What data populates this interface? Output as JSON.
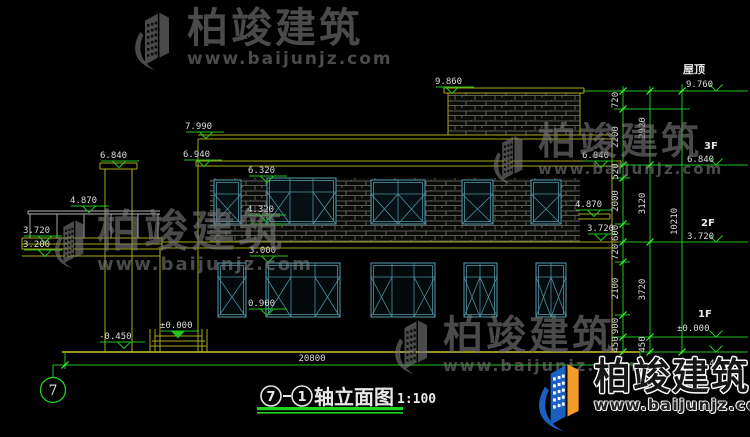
{
  "brand": {
    "name": "柏竣建筑",
    "url": "www.baijunjz.com"
  },
  "title": {
    "axis_from": "7",
    "joiner": "—",
    "axis_to": "1",
    "text": "轴立面图",
    "scale": "1:100"
  },
  "axis_bubble": "7",
  "spot": {
    "stair_roof": "9.860",
    "parapet": "7.990",
    "eave": "6.940",
    "chimney": "6.840",
    "right_eave": "6.840",
    "win2_top": "6.320",
    "balcony": "4.870",
    "right_canopy": "4.870",
    "win2_sill": "4.320",
    "balcony_slab": "3.720",
    "right_slab": "3.720",
    "balcony_beam": "3.200",
    "win1_top": "3.000",
    "win1_sill": "0.900",
    "entrance": "±0.000",
    "ground": "-0.450"
  },
  "levels": [
    {
      "name": "屋顶",
      "value": "9.760"
    },
    {
      "name": "3F",
      "value": "6.840"
    },
    {
      "name": "2F",
      "value": "3.720"
    },
    {
      "name": "1F",
      "value": "±0.000"
    },
    {
      "name": "",
      "value": "-0.450"
    }
  ],
  "dims": {
    "total_width": "20800",
    "chain_inner": [
      "720",
      "2200",
      "520",
      "2000",
      "600",
      "720",
      "2100",
      "900",
      "450"
    ],
    "chain_mid": [
      "2920",
      "3120",
      "3720",
      "450"
    ],
    "overall": "10210"
  },
  "colors": {
    "background": "#000000",
    "dim_green": "#21c521",
    "line_yellow": "#a8a816",
    "window_teal": "#4e8e9e",
    "text_white": "#dcdcdc",
    "watermark_gray": "#787878",
    "brand_blue": "#1a60c0",
    "brand_orange": "#f19c2b"
  }
}
